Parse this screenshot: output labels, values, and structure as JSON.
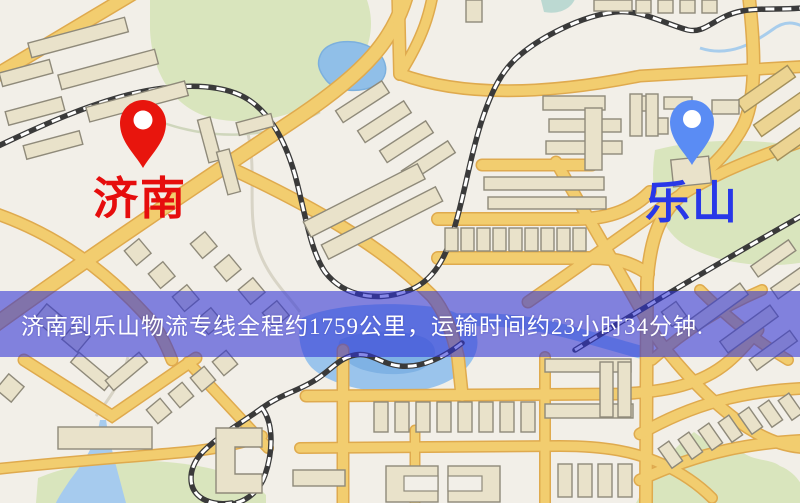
{
  "map": {
    "origin": {
      "label": "济南",
      "pin_color": "#e8150d",
      "label_color": "#e60d0d"
    },
    "destination": {
      "label": "乐山",
      "pin_color": "#5a8cf4",
      "label_color": "#2838e8"
    },
    "banner": {
      "text": "济南到乐山物流专线全程约1759公里，运输时间约23小时34分钟.",
      "bg_color": "rgba(47,50,214,0.58)",
      "text_color": "#ffffff"
    },
    "colors": {
      "background": "#f2efe8",
      "road": "#f2cd6f",
      "road_casing": "#dfaa4e",
      "park": "#d9e5bd",
      "water": "#9ac4ec",
      "building": "#e9e2ca",
      "railway": "#3a3a3a"
    }
  }
}
